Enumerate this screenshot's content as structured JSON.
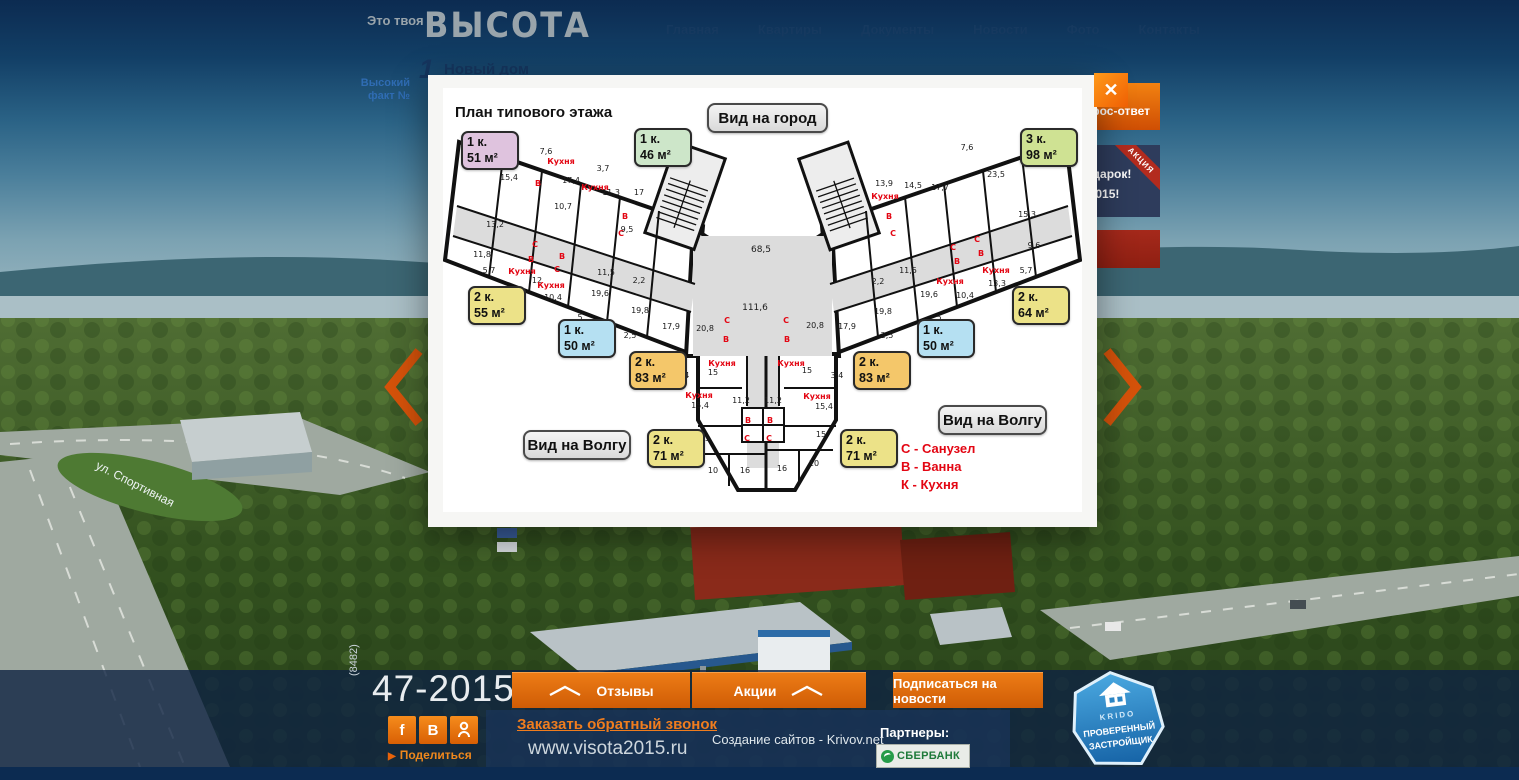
{
  "header": {
    "tagline": "Это твоя",
    "brand": "ВЫСОТА",
    "nav": [
      "Главная",
      "Квартиры",
      "Документы",
      "Новости",
      "Фото",
      "Контакты"
    ],
    "fact_line1": "Высокий",
    "fact_line2": "факт №",
    "fact_number": "1",
    "fact_title": "Новый дом"
  },
  "side": {
    "qa_label": "Вопрос-ответ",
    "promo_ribbon": "АКЦИЯ",
    "promo_line1": "подарок!",
    "promo_line2": "7-2015!"
  },
  "modal": {
    "title": "План типового этажа",
    "close_glyph": "✕",
    "view_city": "Вид на город",
    "view_volga_left": "Вид на Волгу",
    "view_volga_right": "Вид на Волгу",
    "legend": [
      "С - Санузел",
      "В - Ванна",
      "К - Кухня"
    ],
    "apartments": [
      {
        "rooms": "1 к.",
        "area": "51 м²",
        "color": "#dfc3de"
      },
      {
        "rooms": "1 к.",
        "area": "46 м²",
        "color": "#cde6c9"
      },
      {
        "rooms": "3 к.",
        "area": "98 м²",
        "color": "#cfe293"
      },
      {
        "rooms": "2 к.",
        "area": "55 м²",
        "color": "#ece288"
      },
      {
        "rooms": "1 к.",
        "area": "50 м²",
        "color": "#b5e0f2"
      },
      {
        "rooms": "2 к.",
        "area": "83 м²",
        "color": "#f4c76a"
      },
      {
        "rooms": "2 к.",
        "area": "83 м²",
        "color": "#f4c76a"
      },
      {
        "rooms": "1 к.",
        "area": "50 м²",
        "color": "#b5e0f2"
      },
      {
        "rooms": "2 к.",
        "area": "64 м²",
        "color": "#ece288"
      },
      {
        "rooms": "2 к.",
        "area": "71 м²",
        "color": "#ece288"
      },
      {
        "rooms": "2 к.",
        "area": "71 м²",
        "color": "#ece288"
      }
    ],
    "room_labels": [
      {
        "x": 103,
        "y": 66,
        "t": "7,6"
      },
      {
        "x": 66,
        "y": 92,
        "t": "15,4"
      },
      {
        "x": 128,
        "y": 95,
        "t": "17,4"
      },
      {
        "x": 160,
        "y": 83,
        "t": "3,7"
      },
      {
        "x": 168,
        "y": 107,
        "t": "11,3"
      },
      {
        "x": 196,
        "y": 107,
        "t": "17"
      },
      {
        "x": 120,
        "y": 121,
        "t": "10,7"
      },
      {
        "x": 52,
        "y": 139,
        "t": "13,2"
      },
      {
        "x": 184,
        "y": 144,
        "t": "9,5"
      },
      {
        "x": 39,
        "y": 169,
        "t": "11,8"
      },
      {
        "x": 46,
        "y": 185,
        "t": "5,7"
      },
      {
        "x": 94,
        "y": 195,
        "t": "12"
      },
      {
        "x": 110,
        "y": 212,
        "t": "10,4"
      },
      {
        "x": 163,
        "y": 187,
        "t": "11,5"
      },
      {
        "x": 157,
        "y": 208,
        "t": "19,6"
      },
      {
        "x": 196,
        "y": 195,
        "t": "2,2"
      },
      {
        "x": 197,
        "y": 225,
        "t": "19,8"
      },
      {
        "x": 137,
        "y": 232,
        "t": "5"
      },
      {
        "x": 187,
        "y": 250,
        "t": "2,5"
      },
      {
        "x": 228,
        "y": 241,
        "t": "17,9"
      },
      {
        "x": 262,
        "y": 243,
        "t": "20,8"
      },
      {
        "x": 240,
        "y": 290,
        "t": "3,4"
      },
      {
        "x": 270,
        "y": 287,
        "t": "15"
      },
      {
        "x": 257,
        "y": 320,
        "t": "15,4"
      },
      {
        "x": 118,
        "y": 76,
        "t": "Кухня",
        "r": 1
      },
      {
        "x": 95,
        "y": 98,
        "t": "В",
        "r": 1
      },
      {
        "x": 152,
        "y": 102,
        "t": "Кухня",
        "r": 1
      },
      {
        "x": 182,
        "y": 131,
        "t": "В",
        "r": 1
      },
      {
        "x": 178,
        "y": 148,
        "t": "С",
        "r": 1
      },
      {
        "x": 92,
        "y": 159,
        "t": "С",
        "r": 1
      },
      {
        "x": 88,
        "y": 174,
        "t": "В",
        "r": 1
      },
      {
        "x": 79,
        "y": 186,
        "t": "Кухня",
        "r": 1
      },
      {
        "x": 119,
        "y": 171,
        "t": "В",
        "r": 1
      },
      {
        "x": 114,
        "y": 184,
        "t": "С",
        "r": 1
      },
      {
        "x": 108,
        "y": 200,
        "t": "Кухня",
        "r": 1
      },
      {
        "x": 284,
        "y": 235,
        "t": "С",
        "r": 1
      },
      {
        "x": 283,
        "y": 254,
        "t": "В",
        "r": 1
      },
      {
        "x": 279,
        "y": 278,
        "t": "Кухня",
        "r": 1
      },
      {
        "x": 256,
        "y": 310,
        "t": "Кухня",
        "r": 1
      },
      {
        "x": 318,
        "y": 164,
        "t": "68,5",
        "big": 1
      },
      {
        "x": 312,
        "y": 222,
        "t": "111,6",
        "big": 1
      },
      {
        "x": 298,
        "y": 315,
        "t": "11,2"
      },
      {
        "x": 330,
        "y": 315,
        "t": "11,2"
      },
      {
        "x": 305,
        "y": 335,
        "t": "В",
        "r": 1
      },
      {
        "x": 327,
        "y": 335,
        "t": "В",
        "r": 1
      },
      {
        "x": 304,
        "y": 353,
        "t": "С",
        "r": 1
      },
      {
        "x": 326,
        "y": 353,
        "t": "С",
        "r": 1
      },
      {
        "x": 262,
        "y": 353,
        "t": "15"
      },
      {
        "x": 378,
        "y": 349,
        "t": "15"
      },
      {
        "x": 270,
        "y": 385,
        "t": "10"
      },
      {
        "x": 371,
        "y": 378,
        "t": "10"
      },
      {
        "x": 302,
        "y": 385,
        "t": "16"
      },
      {
        "x": 339,
        "y": 383,
        "t": "16"
      },
      {
        "x": 374,
        "y": 311,
        "t": "Кухня",
        "r": 1
      },
      {
        "x": 381,
        "y": 321,
        "t": "15,4"
      },
      {
        "x": 524,
        "y": 62,
        "t": "7,6"
      },
      {
        "x": 553,
        "y": 89,
        "t": "23,5"
      },
      {
        "x": 497,
        "y": 102,
        "t": "17,7"
      },
      {
        "x": 470,
        "y": 100,
        "t": "14,5"
      },
      {
        "x": 441,
        "y": 98,
        "t": "13,9"
      },
      {
        "x": 584,
        "y": 129,
        "t": "15,3"
      },
      {
        "x": 591,
        "y": 160,
        "t": "9,6"
      },
      {
        "x": 583,
        "y": 185,
        "t": "5,7"
      },
      {
        "x": 554,
        "y": 198,
        "t": "13,3"
      },
      {
        "x": 522,
        "y": 210,
        "t": "10,4"
      },
      {
        "x": 486,
        "y": 209,
        "t": "19,6"
      },
      {
        "x": 465,
        "y": 185,
        "t": "11,5"
      },
      {
        "x": 435,
        "y": 196,
        "t": "2,2"
      },
      {
        "x": 440,
        "y": 226,
        "t": "19,8"
      },
      {
        "x": 404,
        "y": 241,
        "t": "17,9"
      },
      {
        "x": 372,
        "y": 240,
        "t": "20,8"
      },
      {
        "x": 444,
        "y": 250,
        "t": "2,5"
      },
      {
        "x": 496,
        "y": 232,
        "t": "5"
      },
      {
        "x": 364,
        "y": 285,
        "t": "15"
      },
      {
        "x": 394,
        "y": 290,
        "t": "3,4"
      },
      {
        "x": 442,
        "y": 111,
        "t": "Кухня",
        "r": 1
      },
      {
        "x": 446,
        "y": 131,
        "t": "В",
        "r": 1
      },
      {
        "x": 450,
        "y": 148,
        "t": "С",
        "r": 1
      },
      {
        "x": 510,
        "y": 162,
        "t": "С",
        "r": 1
      },
      {
        "x": 514,
        "y": 176,
        "t": "В",
        "r": 1
      },
      {
        "x": 507,
        "y": 196,
        "t": "Кухня",
        "r": 1
      },
      {
        "x": 534,
        "y": 154,
        "t": "С",
        "r": 1
      },
      {
        "x": 538,
        "y": 168,
        "t": "В",
        "r": 1
      },
      {
        "x": 553,
        "y": 185,
        "t": "Кухня",
        "r": 1
      },
      {
        "x": 343,
        "y": 235,
        "t": "С",
        "r": 1
      },
      {
        "x": 344,
        "y": 254,
        "t": "В",
        "r": 1
      },
      {
        "x": 348,
        "y": 278,
        "t": "Кухня",
        "r": 1
      }
    ]
  },
  "footer": {
    "area_code": "(8482)",
    "phone": "47-2015",
    "social": [
      {
        "name": "facebook",
        "glyph": "f"
      },
      {
        "name": "vk",
        "glyph": "В"
      },
      {
        "name": "odnoklassniki",
        "glyph": ""
      }
    ],
    "share": "Поделиться",
    "callback": "Заказать обратный звонок",
    "url": "www.visota2015.ru",
    "btn_reviews": "Отзывы",
    "btn_promos": "Акции",
    "btn_subscribe": "Подписаться на новости",
    "credits": "Создание сайтов - Krivov.net",
    "partners_label": "Партнеры:",
    "sberbank": "СБЕРБАНК",
    "badge_brand": "KRIDO",
    "badge_line1": "ПРОВЕРЕННЫЙ",
    "badge_line2": "ЗАСТРОЙЩИК"
  },
  "background": {
    "street": "ул. Спортивная"
  }
}
